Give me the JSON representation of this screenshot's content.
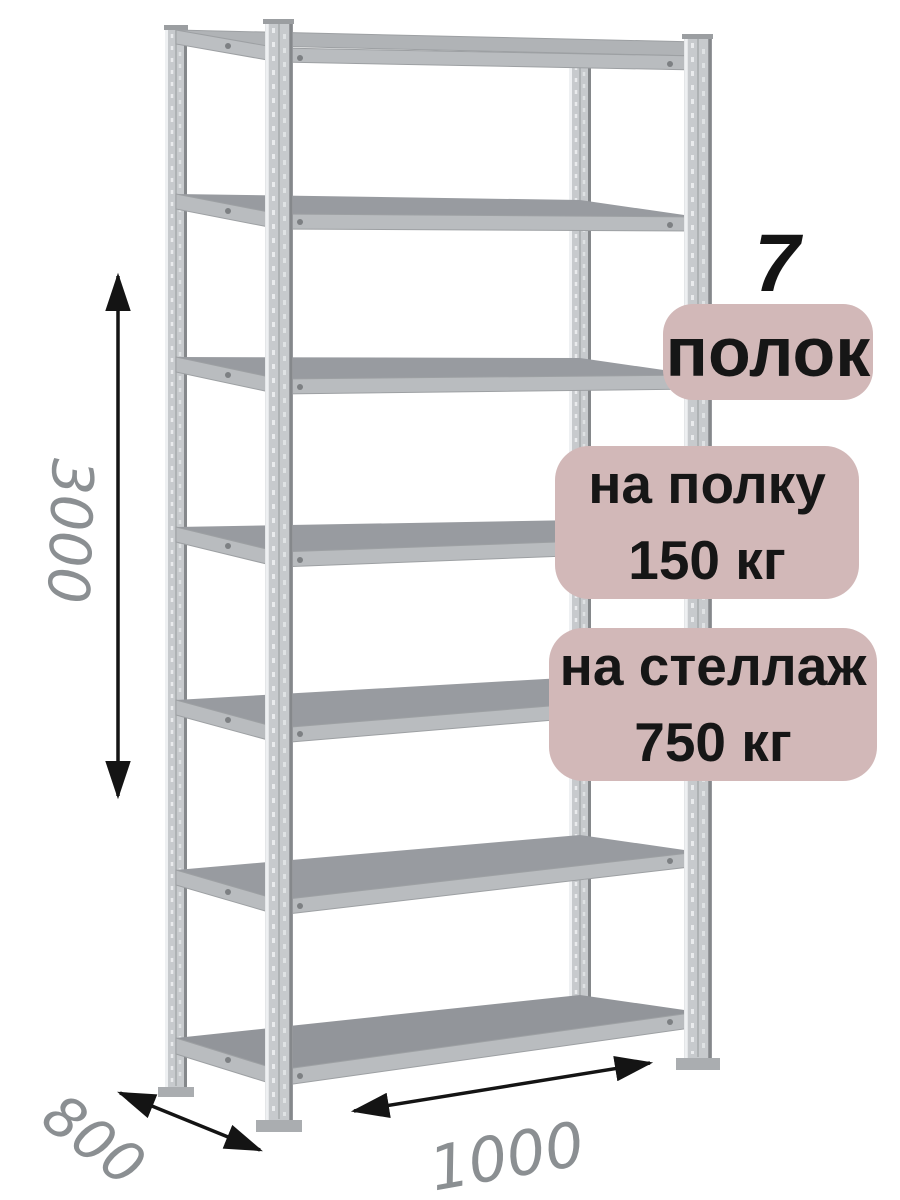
{
  "badges": {
    "shelf_count": "7",
    "shelf_count_label": "полок",
    "per_shelf_line1": "на полку",
    "per_shelf_line2": "150 кг",
    "per_rack_line1": "на стеллаж",
    "per_rack_line2": "750 кг",
    "badge_bg_color": "#d2b8b8",
    "badge_text_color": "#161616"
  },
  "dimensions": {
    "height_mm": "3000",
    "depth_mm": "800",
    "width_mm": "1000",
    "label_color": "#8b8f92",
    "arrow_color": "#141414"
  },
  "illustration": {
    "subject": "metal-boltless-shelving-rack",
    "shelf_count": 7,
    "metal_light": "#c7cacd",
    "metal_beam": "#b9bcbf",
    "metal_shelf_top": "#989ba0",
    "background": "#ffffff"
  }
}
